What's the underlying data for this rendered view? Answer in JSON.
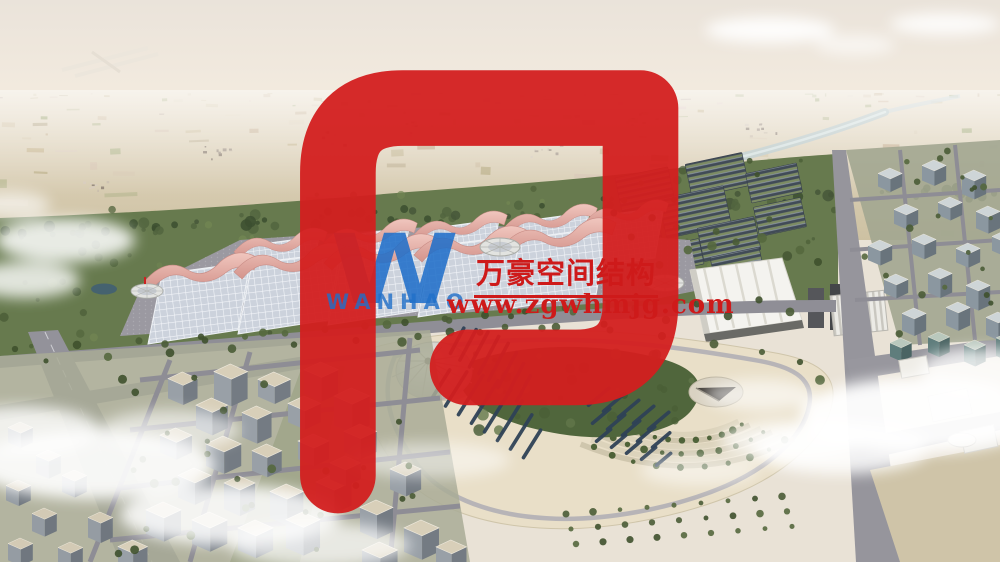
{
  "watermark": {
    "logo_monogram": "W",
    "logo_wordmark": "WANHAO",
    "company_name": "万豪空间结构",
    "website": "www.zgwhmjg.com",
    "colors": {
      "logo_blue": "#1f6fc9",
      "text_red": "#ce1a1a"
    }
  },
  "scene": {
    "palette": {
      "sky_haze": "#ece5da",
      "farmland": "#d5c6a8",
      "river": "#b6c6c8",
      "tree_belt": "#55683e",
      "hall_roof": "#ccd2dc",
      "canopy_pink": "#e2aba3",
      "road": "#92919a",
      "park_plaza": "#e9dfc8",
      "park_green": "#50663c",
      "solar_panel": "#414b57",
      "city_roof": "#d8cfb9",
      "cloud": "#ffffff"
    }
  }
}
